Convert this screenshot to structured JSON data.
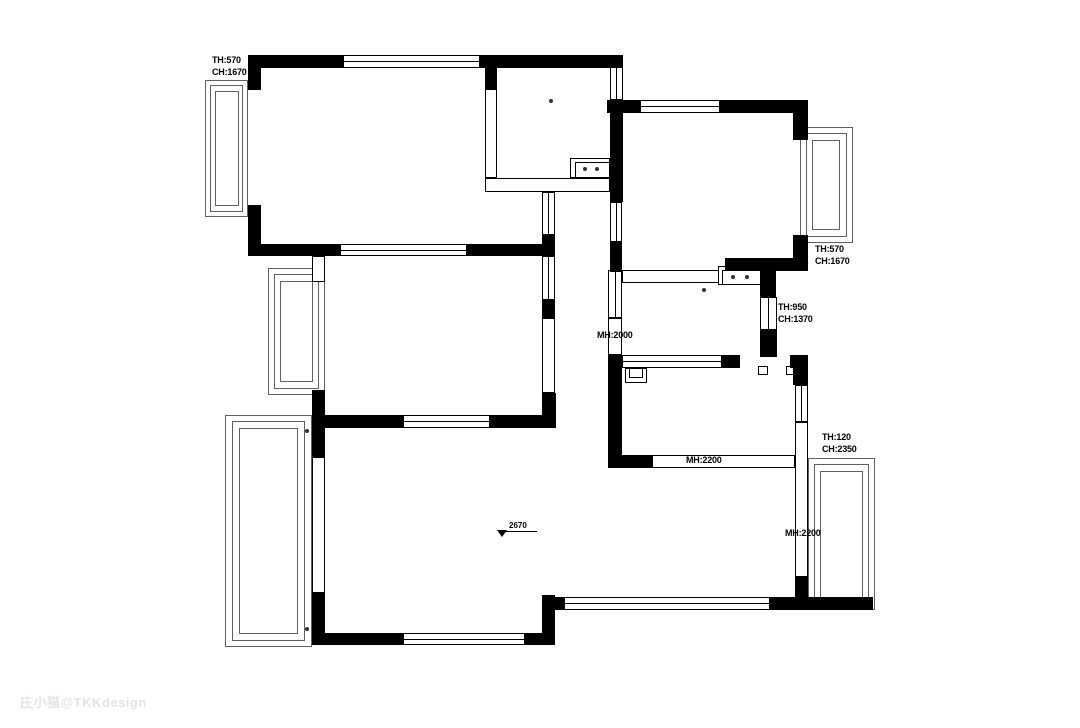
{
  "watermark": "庄小猫@TKKdesign",
  "plan": {
    "wall_color": "#000000",
    "frame_color": "#606060",
    "background": "#ffffff",
    "walls": [
      [
        248,
        55,
        95,
        13
      ],
      [
        480,
        55,
        143,
        13
      ],
      [
        248,
        55,
        13,
        35
      ],
      [
        248,
        205,
        13,
        51
      ],
      [
        248,
        244,
        92,
        12
      ],
      [
        467,
        244,
        88,
        12
      ],
      [
        485,
        68,
        12,
        22
      ],
      [
        610,
        100,
        13,
        102
      ],
      [
        610,
        242,
        12,
        30
      ],
      [
        607,
        100,
        33,
        13
      ],
      [
        720,
        100,
        88,
        13
      ],
      [
        793,
        100,
        15,
        40
      ],
      [
        793,
        235,
        15,
        35
      ],
      [
        725,
        258,
        83,
        13
      ],
      [
        760,
        270,
        16,
        27
      ],
      [
        760,
        330,
        17,
        27
      ],
      [
        608,
        355,
        14,
        113
      ],
      [
        608,
        455,
        44,
        13
      ],
      [
        722,
        355,
        18,
        13
      ],
      [
        790,
        355,
        18,
        13
      ],
      [
        793,
        368,
        15,
        17
      ],
      [
        542,
        235,
        13,
        21
      ],
      [
        542,
        300,
        13,
        18
      ],
      [
        542,
        393,
        14,
        35
      ],
      [
        322,
        415,
        81,
        13
      ],
      [
        490,
        415,
        66,
        13
      ],
      [
        312,
        390,
        13,
        67
      ],
      [
        312,
        593,
        13,
        52
      ],
      [
        312,
        633,
        91,
        12
      ],
      [
        525,
        633,
        30,
        12
      ],
      [
        542,
        595,
        13,
        50
      ],
      [
        552,
        597,
        13,
        13
      ],
      [
        770,
        597,
        103,
        13
      ],
      [
        795,
        577,
        13,
        33
      ]
    ],
    "windows_h": [
      [
        343,
        55,
        137,
        13
      ],
      [
        340,
        244,
        127,
        12
      ],
      [
        403,
        415,
        87,
        13
      ],
      [
        403,
        633,
        122,
        12
      ],
      [
        563,
        597,
        207,
        13
      ],
      [
        640,
        100,
        80,
        13
      ],
      [
        622,
        355,
        100,
        13
      ]
    ],
    "windows_v": [
      [
        610,
        67,
        13,
        33
      ],
      [
        610,
        202,
        12,
        40
      ],
      [
        608,
        270,
        14,
        48
      ],
      [
        760,
        297,
        17,
        33
      ],
      [
        542,
        256,
        13,
        44
      ],
      [
        542,
        192,
        13,
        43
      ],
      [
        795,
        385,
        13,
        37
      ]
    ],
    "partitions": [
      [
        485,
        88,
        12,
        90
      ],
      [
        485,
        178,
        125,
        14
      ],
      [
        622,
        270,
        100,
        13
      ],
      [
        652,
        455,
        143,
        13
      ],
      [
        795,
        422,
        13,
        155
      ],
      [
        312,
        457,
        13,
        136
      ],
      [
        542,
        318,
        13,
        75
      ],
      [
        312,
        256,
        13,
        26
      ],
      [
        608,
        318,
        14,
        37
      ],
      [
        570,
        158,
        40,
        20
      ],
      [
        575,
        162,
        35,
        16
      ],
      [
        718,
        266,
        44,
        19
      ],
      [
        722,
        270,
        40,
        15
      ],
      [
        758,
        366,
        10,
        9
      ],
      [
        786,
        366,
        10,
        9
      ],
      [
        625,
        368,
        22,
        15
      ],
      [
        629,
        368,
        14,
        10
      ]
    ],
    "frames": [
      [
        205,
        80,
        43,
        137
      ],
      [
        210,
        85,
        33,
        127
      ],
      [
        215,
        91,
        24,
        115
      ],
      [
        268,
        268,
        57,
        127
      ],
      [
        274,
        274,
        45,
        115
      ],
      [
        280,
        281,
        33,
        101
      ],
      [
        225,
        415,
        87,
        232
      ],
      [
        232,
        421,
        73,
        220
      ],
      [
        239,
        428,
        59,
        206
      ],
      [
        800,
        127,
        53,
        116
      ],
      [
        806,
        133,
        41,
        104
      ],
      [
        812,
        140,
        28,
        90
      ],
      [
        808,
        458,
        67,
        152
      ],
      [
        814,
        464,
        55,
        140
      ],
      [
        820,
        471,
        43,
        127
      ]
    ],
    "dots": [
      [
        551,
        101
      ],
      [
        585,
        169
      ],
      [
        597,
        169
      ],
      [
        704,
        290
      ],
      [
        733,
        277
      ],
      [
        747,
        277
      ],
      [
        307,
        431
      ],
      [
        307,
        629
      ]
    ],
    "labels": [
      {
        "x": 212,
        "y": 55,
        "lines": [
          "TH:570",
          "CH:1670"
        ]
      },
      {
        "x": 815,
        "y": 244,
        "lines": [
          "TH:570",
          "CH:1670"
        ]
      },
      {
        "x": 778,
        "y": 302,
        "lines": [
          "TH:950",
          "CH:1370"
        ]
      },
      {
        "x": 822,
        "y": 432,
        "lines": [
          "TH:120",
          "CH:2350"
        ]
      },
      {
        "x": 597,
        "y": 330,
        "lines": [
          "MH:2000"
        ]
      },
      {
        "x": 686,
        "y": 455,
        "lines": [
          "MH:2200"
        ]
      },
      {
        "x": 785,
        "y": 528,
        "lines": [
          "MH:2200"
        ]
      }
    ],
    "level_marker": {
      "value": "2670",
      "x": 497,
      "y": 530,
      "line_w": 36
    }
  }
}
